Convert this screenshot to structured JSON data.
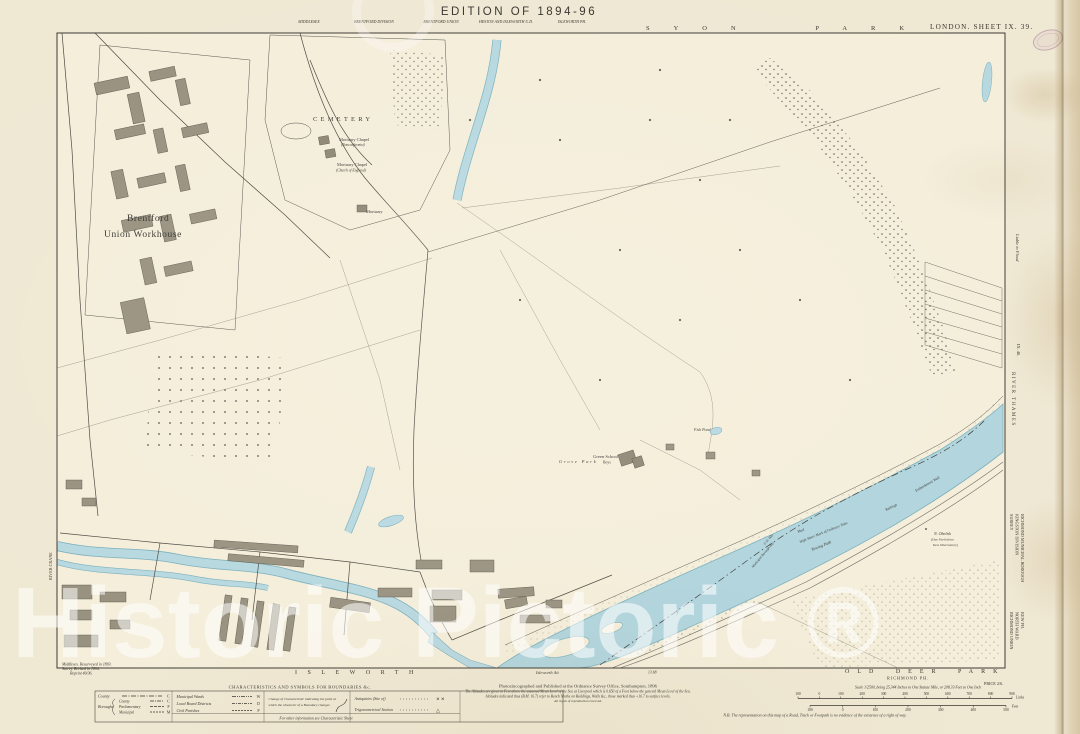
{
  "page": {
    "watermark": "Historic Pictoric ®"
  },
  "header": {
    "edition_title": "EDITION OF 1894-96",
    "admin": [
      "MIDDLESEX",
      "BRENTFORD DIVISION",
      "BRENTFORD UNION",
      "HESTON AND ISLEWORTH U.D.",
      "ISLEWORTH PH."
    ],
    "sheet_label": "LONDON. SHEET IX. 39."
  },
  "margin": {
    "top_park": "SYON PARK",
    "left_river": "RIVER CRANE",
    "right": {
      "liable_to_flood": "Liable to Flood",
      "adjacent_sheet": "IX. 40.",
      "river_thames": "RIVER THAMES",
      "county": "SURREY",
      "division": "KINGSTON DIVISION",
      "borough": "RICHMOND MUNICIPAL BOROUGH",
      "union": "RICHMOND UNION",
      "ward": "NORTH WARD",
      "parish": "KEW PH."
    },
    "bottom": {
      "isleworth": "ISLEWORTH",
      "isleworth_ait": "Isleworth Ait",
      "chainage": "13.68",
      "old_deer_park": "OLD DEER PARK",
      "richmond_ph": "RICHMOND PH.",
      "price": "PRICE 2/6."
    }
  },
  "map_labels": {
    "cemetery": "CEMETERY",
    "mortuary_chapel_a": "Mortuary Chapel",
    "mortuary_chapel_a_sub": "(Nonconformist)",
    "mortuary_chapel_b": "Mortuary Chapel",
    "mortuary_chapel_b_sub": "(Church of England)",
    "mortuary": "Mortuary",
    "workhouse_line1": "Brentford",
    "workhouse_line2": "Union Workhouse",
    "green_school": "Green School",
    "green_school_sub": "Boys",
    "grove_park": "Grove Park",
    "fish_pond": "Fish Pond",
    "mud": "Mud",
    "high_water_mark": "High Water Mark of Ordinary Tides",
    "towing_path": "Towing Path",
    "railings": "Railings",
    "embankment": "Embankment Wall",
    "obelisk_line1": "N. Obelisk",
    "obelisk_line2": "(Due North from",
    "obelisk_line3": "Kew Observatory)",
    "ud_boundary": "U.D. Bdy.",
    "borough_boundary": "Municipal Borough Bdy."
  },
  "legend": {
    "title": "CHARACTERISTICS AND SYMBOLS FOR BOUNDARIES &c.",
    "county": "County",
    "boroughs": "Boroughs",
    "borough_types": [
      "County",
      "Parliamentary",
      "Municipal"
    ],
    "col1_letters": [
      "C",
      "C",
      "P",
      "M"
    ],
    "col2_rows": [
      "Municipal Wards",
      "Local Board Districts",
      "Civil Parishes"
    ],
    "col2_letters": [
      "W",
      "D",
      "P"
    ],
    "change_line1": "Change of Characteristic indicating the point at",
    "change_line2": "which the character of a Boundary changes",
    "antiquities": "Antiquities (Site of)",
    "antiquities_mark": "✕ ✕",
    "trig_station": "Trigonometrical Station",
    "trig_mark": "△",
    "footer_note": "For other information see Characteristic Sheet"
  },
  "footer": {
    "edition_notes": [
      "Middlesex. Resurveyed in 1893.",
      "Surrey. Revised in 1894.",
      "Reprint 40/36."
    ],
    "publication": [
      "Photozincographed and Published at the Ordnance Survey Office, Southampton, 1896",
      "The Altitudes are given in Feet above the assumed Mean Level of the Sea at Liverpool which is 0.650 of a Foot below the general Mean Level of the Sea.",
      "Altitudes indicated thus (B.M. 16.7) refer to Bench Marks on Buildings, Walls &c., those marked thus +16.7 to surface levels.",
      "All rights of reproduction reserved."
    ],
    "scale_title": "Scale 1/2500, being 25.344 Inches to One Statute Mile, or 208.33 Feet to One Inch",
    "scale_links_ticks": [
      "100",
      "0",
      "100",
      "200",
      "300",
      "400",
      "500",
      "600",
      "700",
      "800",
      "900"
    ],
    "scale_links_unit": "Links",
    "scale_feet_ticks": [
      "100",
      "0",
      "100",
      "200",
      "300",
      "400",
      "500"
    ],
    "scale_feet_unit": "Feet",
    "nb_note": "N.B. The representation on this map of a Road, Track or Footpath is no evidence of the existence of a right of way."
  },
  "colors": {
    "paper": "#efe8d3",
    "map_face": "#f4eeda",
    "water": "#b7d8e0",
    "ink": "#3a3833"
  }
}
